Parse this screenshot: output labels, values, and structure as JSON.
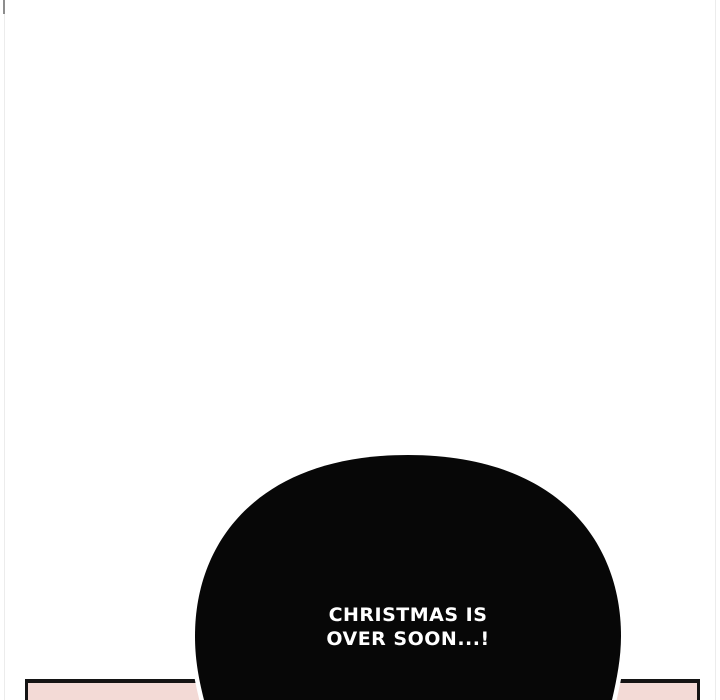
{
  "page": {
    "background_color": "#ffffff",
    "margin_line_color": "#ececec"
  },
  "speech_bubble": {
    "line1": "CHRISTMAS IS",
    "line2": "OVER SOON...!",
    "fill_color": "#070707",
    "text_color": "#ffffff",
    "halo_color": "#ffffff"
  },
  "bottom_panel": {
    "fill_color": "#f3dad6",
    "border_color": "#141414"
  }
}
